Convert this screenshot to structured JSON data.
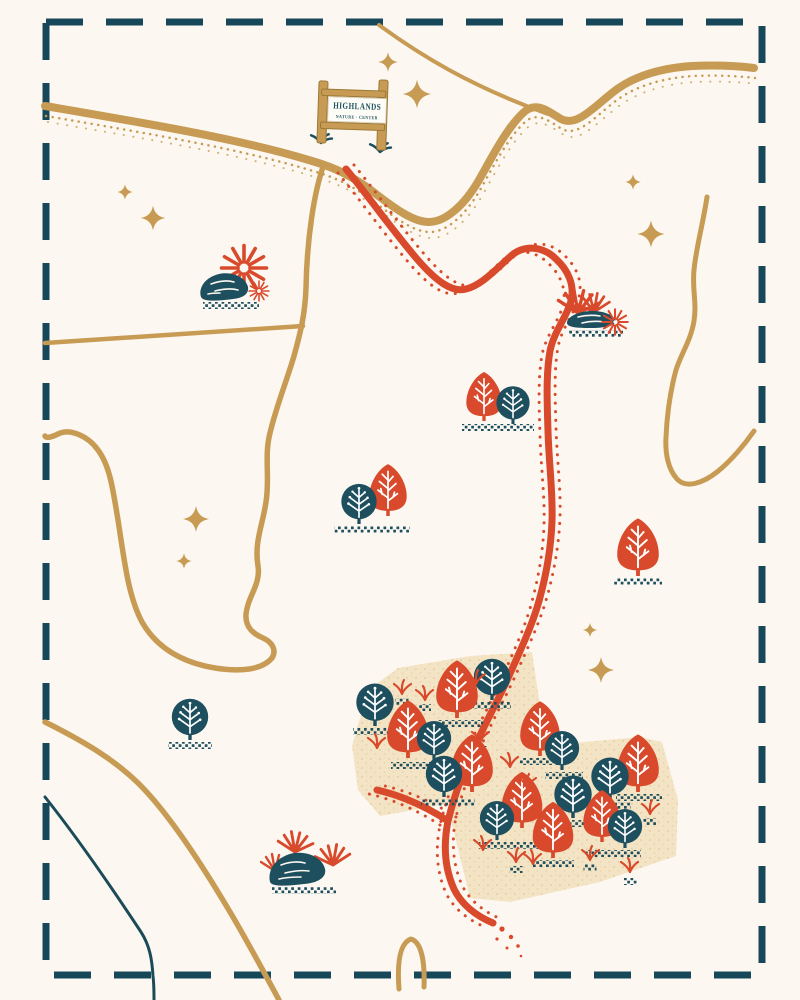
{
  "sign": {
    "line1": "HIGHLANDS",
    "line2": "NATURE · CENTER"
  },
  "colors": {
    "background": "#fcf8f1",
    "border_teal": "#17485a",
    "road_gold": "#c79b54",
    "trail_red": "#d84a2b",
    "tree_teal": "#1e4f5e",
    "forest_patch_beige": "#f4e4c6",
    "sign_board_white": "#fdfcf6"
  },
  "features": {
    "sparkles": [
      {
        "x": 388,
        "y": 62,
        "s": 0.75
      },
      {
        "x": 417,
        "y": 94,
        "s": 1.1
      },
      {
        "x": 125,
        "y": 192,
        "s": 0.6
      },
      {
        "x": 153,
        "y": 218,
        "s": 0.95
      },
      {
        "x": 633,
        "y": 182,
        "s": 0.6
      },
      {
        "x": 651,
        "y": 234,
        "s": 1.05
      },
      {
        "x": 196,
        "y": 519,
        "s": 1.0
      },
      {
        "x": 184,
        "y": 561,
        "s": 0.6
      },
      {
        "x": 590,
        "y": 630,
        "s": 0.55
      },
      {
        "x": 601,
        "y": 670,
        "s": 1.0
      }
    ],
    "trees": [
      {
        "t": "red",
        "x": 484,
        "y": 421,
        "s": 0.68
      },
      {
        "t": "teal",
        "x": 513,
        "y": 424,
        "s": 0.64
      },
      {
        "t": "red",
        "x": 388,
        "y": 516,
        "s": 0.72
      },
      {
        "t": "teal",
        "x": 359,
        "y": 524,
        "s": 0.68
      },
      {
        "t": "red",
        "x": 638,
        "y": 576,
        "s": 0.8
      },
      {
        "t": "teal",
        "x": 190,
        "y": 740,
        "s": 0.7
      },
      {
        "t": "teal",
        "x": 375,
        "y": 726,
        "s": 0.72
      },
      {
        "t": "red",
        "x": 457,
        "y": 718,
        "s": 0.8
      },
      {
        "t": "teal",
        "x": 492,
        "y": 700,
        "s": 0.7
      },
      {
        "t": "red",
        "x": 408,
        "y": 758,
        "s": 0.8
      },
      {
        "t": "teal",
        "x": 434,
        "y": 760,
        "s": 0.66
      },
      {
        "t": "red",
        "x": 540,
        "y": 756,
        "s": 0.76
      },
      {
        "t": "teal",
        "x": 562,
        "y": 770,
        "s": 0.66
      },
      {
        "t": "red",
        "x": 472,
        "y": 792,
        "s": 0.8
      },
      {
        "t": "teal",
        "x": 444,
        "y": 797,
        "s": 0.7
      },
      {
        "t": "red",
        "x": 638,
        "y": 792,
        "s": 0.8
      },
      {
        "t": "teal",
        "x": 610,
        "y": 800,
        "s": 0.72
      },
      {
        "t": "teal",
        "x": 573,
        "y": 818,
        "s": 0.72
      },
      {
        "t": "red",
        "x": 522,
        "y": 828,
        "s": 0.78
      },
      {
        "t": "teal",
        "x": 497,
        "y": 840,
        "s": 0.66
      },
      {
        "t": "red",
        "x": 602,
        "y": 842,
        "s": 0.72
      },
      {
        "t": "teal",
        "x": 625,
        "y": 848,
        "s": 0.66
      },
      {
        "t": "red",
        "x": 553,
        "y": 858,
        "s": 0.78
      }
    ],
    "grounds": [
      {
        "x": 498,
        "y": 424,
        "w": 72
      },
      {
        "x": 372,
        "y": 526,
        "w": 76
      },
      {
        "x": 638,
        "y": 578,
        "w": 48
      },
      {
        "x": 190,
        "y": 742,
        "w": 44
      },
      {
        "x": 375,
        "y": 728,
        "w": 44
      },
      {
        "x": 459,
        "y": 720,
        "w": 48
      },
      {
        "x": 492,
        "y": 702,
        "w": 38
      },
      {
        "x": 420,
        "y": 762,
        "w": 58
      },
      {
        "x": 448,
        "y": 799,
        "w": 54
      },
      {
        "x": 541,
        "y": 758,
        "w": 42
      },
      {
        "x": 564,
        "y": 772,
        "w": 38
      },
      {
        "x": 639,
        "y": 794,
        "w": 46
      },
      {
        "x": 611,
        "y": 802,
        "w": 40
      },
      {
        "x": 575,
        "y": 820,
        "w": 42
      },
      {
        "x": 510,
        "y": 842,
        "w": 62
      },
      {
        "x": 613,
        "y": 850,
        "w": 56
      },
      {
        "x": 553,
        "y": 860,
        "w": 42
      },
      {
        "x": 402,
        "y": 698,
        "w": 13
      },
      {
        "x": 480,
        "y": 746,
        "w": 13
      },
      {
        "x": 527,
        "y": 792,
        "w": 13
      },
      {
        "x": 650,
        "y": 818,
        "w": 13
      },
      {
        "x": 516,
        "y": 866,
        "w": 13
      },
      {
        "x": 590,
        "y": 864,
        "w": 13
      },
      {
        "x": 630,
        "y": 878,
        "w": 13
      },
      {
        "x": 425,
        "y": 704,
        "w": 12
      }
    ],
    "grass_red": [
      {
        "x": 402,
        "y": 694
      },
      {
        "x": 425,
        "y": 700,
        "f": true
      },
      {
        "x": 476,
        "y": 684
      },
      {
        "x": 377,
        "y": 748,
        "f": true
      },
      {
        "x": 480,
        "y": 742
      },
      {
        "x": 510,
        "y": 767,
        "f": true
      },
      {
        "x": 527,
        "y": 788
      },
      {
        "x": 650,
        "y": 814
      },
      {
        "x": 483,
        "y": 850,
        "f": true
      },
      {
        "x": 516,
        "y": 862
      },
      {
        "x": 533,
        "y": 864,
        "f": true
      },
      {
        "x": 590,
        "y": 860
      },
      {
        "x": 630,
        "y": 872,
        "f": true
      }
    ],
    "grass_teal": [
      {
        "x": 321,
        "y": 143,
        "s": 1.1
      },
      {
        "x": 380,
        "y": 152,
        "s": 1.1
      }
    ]
  }
}
